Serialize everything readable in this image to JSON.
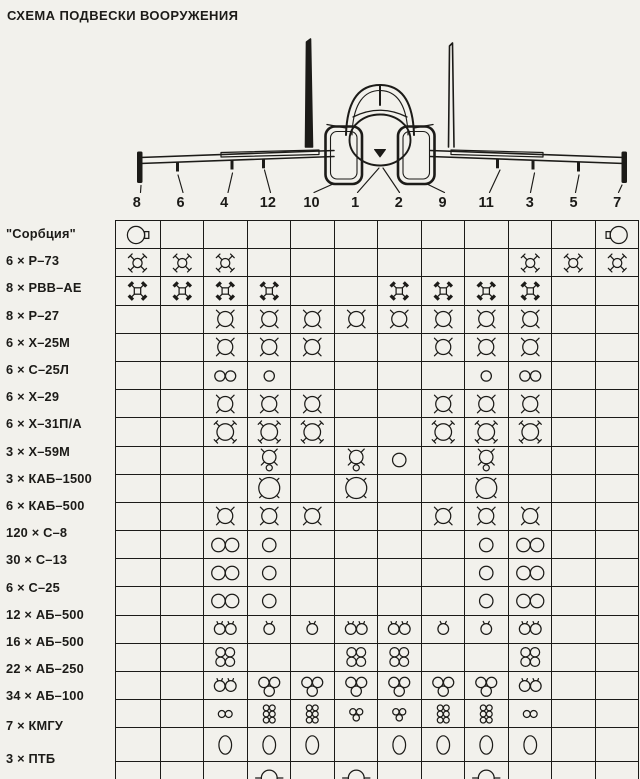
{
  "title": "СХЕМА ПОДВЕСКИ ВООРУЖЕНИЯ",
  "colors": {
    "paper": "#f2f1ec",
    "ink": "#1c1b18"
  },
  "hardpoints": [
    "8",
    "6",
    "4",
    "12",
    "10",
    "1",
    "2",
    "9",
    "11",
    "3",
    "5",
    "7"
  ],
  "symbols": {
    "ecmR": "sorbtsiya-ecm-pod-tab-right",
    "ecmL": "sorbtsiya-ecm-pod-tab-left",
    "r73": "r73-missile-x-fins",
    "rvv": "rvv-ae-missile-lattice-fins",
    "mx": "missile-x-fins",
    "mx2": "large-missile-x-fins",
    "x59": "x59-missile-with-pod",
    "kab15": "kab1500-bomb",
    "pod1": "rocket-pod",
    "pod2": "rocket-pod-pair",
    "pod1s": "small-rocket-pod",
    "pod2s": "small-rocket-pod-pair",
    "b1": "bomb",
    "b2": "bomb-pair",
    "b3": "bomb-triple-cluster",
    "b4": "bomb-quad-cluster",
    "i2": "small-bomb-pair",
    "i3": "small-bomb-triple-cluster",
    "b6": "small-bomb-six-cluster",
    "kmgu": "kmgu-dispenser",
    "ptb": "drop-tank"
  },
  "rows": [
    {
      "label": "\"Сорбция\"",
      "cells": [
        "ecmR",
        null,
        null,
        null,
        null,
        null,
        null,
        null,
        null,
        null,
        null,
        "ecmL"
      ]
    },
    {
      "label": "6 × Р–73",
      "cells": [
        "r73",
        "r73",
        "r73",
        null,
        null,
        null,
        null,
        null,
        null,
        "r73",
        "r73",
        "r73"
      ]
    },
    {
      "label": "8 × РВВ–АЕ",
      "cells": [
        "rvv",
        "rvv",
        "rvv",
        "rvv",
        null,
        null,
        "rvv",
        "rvv",
        "rvv",
        "rvv",
        null,
        null
      ]
    },
    {
      "label": "8 × Р–27",
      "cells": [
        null,
        null,
        "mx",
        "mx",
        "mx",
        "mx",
        "mx",
        "mx",
        "mx",
        "mx",
        null,
        null
      ]
    },
    {
      "label": "6 × Х–25М",
      "cells": [
        null,
        null,
        "mx",
        "mx",
        "mx",
        null,
        null,
        "mx",
        "mx",
        "mx",
        null,
        null
      ]
    },
    {
      "label": "6 × С–25Л",
      "cells": [
        null,
        null,
        "pod2s",
        "pod1s",
        null,
        null,
        null,
        null,
        "pod1s",
        "pod2s",
        null,
        null
      ]
    },
    {
      "label": "6 × Х–29",
      "cells": [
        null,
        null,
        "mx",
        "mx",
        "mx",
        null,
        null,
        "mx",
        "mx",
        "mx",
        null,
        null
      ]
    },
    {
      "label": "6 × Х–31П/А",
      "cells": [
        null,
        null,
        "mx2",
        "mx2",
        "mx2",
        null,
        null,
        "mx2",
        "mx2",
        "mx2",
        null,
        null
      ]
    },
    {
      "label": "3 × Х–59М",
      "cells": [
        null,
        null,
        null,
        "x59",
        null,
        "x59",
        "pod1",
        null,
        "x59",
        null,
        null,
        null
      ]
    },
    {
      "label": "3 × КАБ–1500",
      "cells": [
        null,
        null,
        null,
        "kab15",
        null,
        "kab15",
        null,
        null,
        "kab15",
        null,
        null,
        null
      ]
    },
    {
      "label": "6 × КАБ–500",
      "cells": [
        null,
        null,
        "mx",
        "mx",
        "mx",
        null,
        null,
        "mx",
        "mx",
        "mx",
        null,
        null
      ]
    },
    {
      "label": "120 × С–8",
      "cells": [
        null,
        null,
        "pod2",
        "pod1",
        null,
        null,
        null,
        null,
        "pod1",
        "pod2",
        null,
        null
      ]
    },
    {
      "label": "30 × С–13",
      "cells": [
        null,
        null,
        "pod2",
        "pod1",
        null,
        null,
        null,
        null,
        "pod1",
        "pod2",
        null,
        null
      ]
    },
    {
      "label": "6 × С–25",
      "cells": [
        null,
        null,
        "pod2",
        "pod1",
        null,
        null,
        null,
        null,
        "pod1",
        "pod2",
        null,
        null
      ]
    },
    {
      "label": "12 × АБ–500",
      "cells": [
        null,
        null,
        "b2",
        "b1",
        "b1",
        "b2",
        "b2",
        "b1",
        "b1",
        "b2",
        null,
        null
      ]
    },
    {
      "label": "16 × АБ–500",
      "cells": [
        null,
        null,
        "b4",
        null,
        null,
        "b4",
        "b4",
        null,
        null,
        "b4",
        null,
        null
      ]
    },
    {
      "label": "22 × АБ–250",
      "cells": [
        null,
        null,
        "b2",
        "b3",
        "b3",
        "b3",
        "b3",
        "b3",
        "b3",
        "b2",
        null,
        null
      ]
    },
    {
      "label": "34 × АБ–100",
      "cells": [
        null,
        null,
        "i2",
        "b6",
        "b6",
        "i3",
        "i3",
        "b6",
        "b6",
        "i2",
        null,
        null
      ]
    },
    {
      "label": "7 × КМГУ",
      "cells": [
        null,
        null,
        "kmgu",
        "kmgu",
        "kmgu",
        null,
        "kmgu",
        "kmgu",
        "kmgu",
        "kmgu",
        null,
        null
      ]
    },
    {
      "label": "3 × ПТБ",
      "cells": [
        null,
        null,
        null,
        "ptb",
        null,
        "ptb",
        null,
        null,
        "ptb",
        null,
        null,
        null
      ]
    }
  ]
}
